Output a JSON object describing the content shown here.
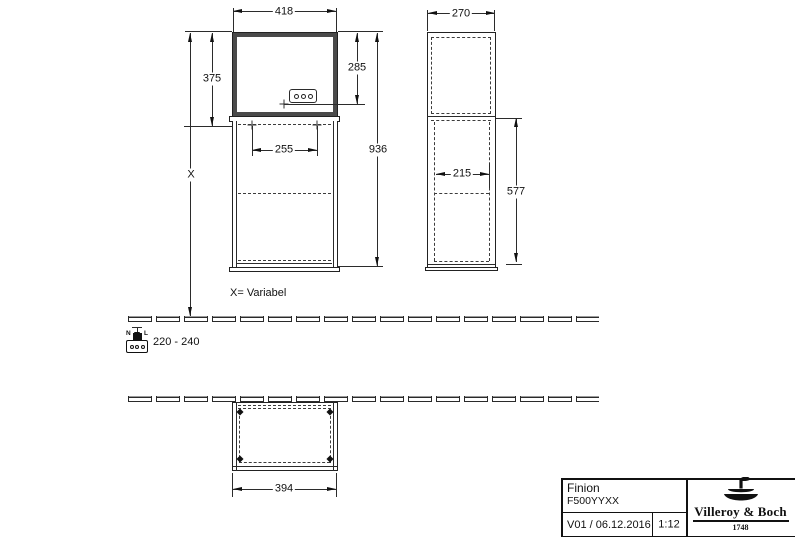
{
  "drawing": {
    "dims": {
      "front_width": "418",
      "front_upper_height": "375",
      "outlet_height": "285",
      "total_height": "936",
      "front_inner_width": "255",
      "variable_height": "X",
      "side_width": "270",
      "side_inner_width": "215",
      "side_lower_height": "577",
      "plan_width": "394"
    },
    "notes": {
      "variable_note": "X= Variabel",
      "voltage_range": "220 - 240",
      "terminal_n": "N",
      "terminal_l": "L"
    },
    "title_block": {
      "product": "Finion",
      "article": "F500YYXX",
      "revision": "V01 / 06.12.2016",
      "scale": "1:12",
      "brand": "Villeroy & Boch",
      "brand_year": "1748"
    },
    "colors": {
      "line": "#2b2b2b",
      "frame": "#4a4a4a",
      "background": "#ffffff"
    }
  }
}
